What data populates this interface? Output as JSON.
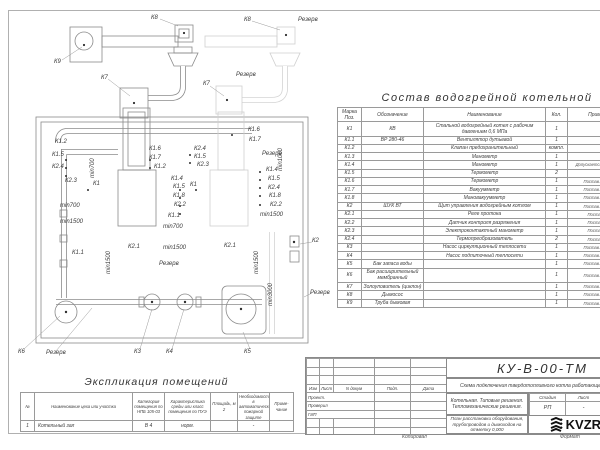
{
  "colors": {
    "line": "#8a8a8a",
    "light_line": "#cfcfcf",
    "text": "#3f3f3f",
    "logo_black": "#111111",
    "paper": "#ffffff"
  },
  "composition_table": {
    "title": "Состав водогрейной котельной",
    "headers": [
      "Марка Поз.",
      "Обозначение",
      "Наименование",
      "Кол.",
      "Примечание"
    ],
    "rows": [
      [
        "К1",
        "КВ",
        "Стальной водогрейный котел с рабочим давлением 0,6 МПа",
        "1",
        ""
      ],
      [
        "К1.1",
        "ВР 280-46",
        "Вентилятор дутьевой",
        "1",
        ""
      ],
      [
        "К1.2",
        "",
        "Клапан предохранительный",
        "компл.",
        ""
      ],
      [
        "К1.3",
        "",
        "Манометр",
        "1",
        ""
      ],
      [
        "К1.4",
        "",
        "Манометр",
        "1",
        "Допускается зам. поз. К2.3"
      ],
      [
        "К1.5",
        "",
        "Термометр",
        "2",
        ""
      ],
      [
        "К1.6",
        "",
        "Термометр",
        "1",
        "Постав. по соглас."
      ],
      [
        "К1.7",
        "",
        "Вакуумметр",
        "1",
        "Постав. по соглас."
      ],
      [
        "К1.8",
        "",
        "Мановакуумметр",
        "1",
        "Постав. по соглас."
      ],
      [
        "К2",
        "ШУК ВТ",
        "Щит управления водогрейным котлом",
        "1",
        "Постав. по соглас."
      ],
      [
        "К2.1",
        "",
        "Реле протока",
        "1",
        "Постав. с ШУК"
      ],
      [
        "К2.2",
        "",
        "Датчик контроля разряжения",
        "1",
        "Постав. с ШУК"
      ],
      [
        "К2.3",
        "",
        "Электроконтактный манометр",
        "1",
        "Постав. с ШУК"
      ],
      [
        "К2.4",
        "",
        "Термопреобразователь",
        "2",
        "Постав. с ШУК"
      ],
      [
        "К3",
        "",
        "Насос циркуляционный теплосети",
        "1",
        "Постав. по соглас."
      ],
      [
        "К4",
        "",
        "Насос подпиточный теплосети",
        "1",
        "Постав. по соглас."
      ],
      [
        "К5",
        "Бак запаса воды",
        "",
        "1",
        "Постав. по соглас."
      ],
      [
        "К6",
        "Бак расширительный мембранный",
        "",
        "1",
        "Постав. по соглас."
      ],
      [
        "К7",
        "Золоуловитель (циклон)",
        "",
        "1",
        "Постав. по соглас."
      ],
      [
        "К8",
        "Дымосос",
        "",
        "1",
        "Постав. по соглас."
      ],
      [
        "К9",
        "Труба дымовая",
        "",
        "1",
        "Постав. по соглас."
      ]
    ]
  },
  "explication_table": {
    "title": "Экспликация помещений",
    "headers": [
      "№",
      "Наименование цеха или участка",
      "Категория помещения по НПБ 105-03",
      "Характеристика среды или класс помещения по ПУЭ",
      "Площадь, м 2",
      "Необходимость в автоматической пожарной защите",
      "Приме- чание"
    ],
    "rows": [
      [
        "1",
        "Котельный зал",
        "В 4",
        "норм.",
        "",
        "-",
        ""
      ]
    ]
  },
  "title_block": {
    "doc_code": "КУ-В-00-ТМ",
    "doc_subtitle": "Схема подключения твердотопливного котла работающего на угле",
    "sign_headers": [
      "Изм",
      "Лист",
      "N докум",
      "Подп.",
      "Дата"
    ],
    "roles": [
      "Проект.",
      "Проверил",
      "ГИП"
    ],
    "object_name": "Котельная. Типовые решения. Тепломеханические решения.",
    "sheet_name": "План расстановки оборудования, трубопроводов и дымоходов на отметку 0,000",
    "stage_headers": [
      "Стадия",
      "Лист",
      "Листов"
    ],
    "stage_values": [
      "РП",
      "-",
      "-"
    ],
    "logo_text": "KVZR",
    "logo_caption_line1": "КОТЕЛЬН",
    "logo_caption_line2": "ЗАВОД Р",
    "copied_label": "Копировал",
    "format_label": "Формат"
  },
  "drawing_labels": [
    {
      "t": "К9",
      "x": 54,
      "y": 59
    },
    {
      "t": "К8",
      "x": 151,
      "y": 15
    },
    {
      "t": "К8",
      "x": 244,
      "y": 17
    },
    {
      "t": "Резерв",
      "x": 298,
      "y": 17
    },
    {
      "t": "К7",
      "x": 101,
      "y": 75
    },
    {
      "t": "К7",
      "x": 203,
      "y": 81
    },
    {
      "t": "Резерв",
      "x": 236,
      "y": 72
    },
    {
      "t": "К1.2",
      "x": 55,
      "y": 139
    },
    {
      "t": "К1.5",
      "x": 52,
      "y": 152
    },
    {
      "t": "К2.4",
      "x": 52,
      "y": 164
    },
    {
      "t": "К2.3",
      "x": 65,
      "y": 178
    },
    {
      "t": "К1",
      "x": 93,
      "y": 181
    },
    {
      "t": "min700",
      "x": 96,
      "y": 172,
      "r": 1
    },
    {
      "t": "К1.6",
      "x": 149,
      "y": 146
    },
    {
      "t": "К1.7",
      "x": 149,
      "y": 155
    },
    {
      "t": "К1.2",
      "x": 154,
      "y": 164
    },
    {
      "t": "К2.4",
      "x": 194,
      "y": 146
    },
    {
      "t": "К1.5",
      "x": 194,
      "y": 154
    },
    {
      "t": "К2.3",
      "x": 197,
      "y": 162
    },
    {
      "t": "К1.4",
      "x": 171,
      "y": 176
    },
    {
      "t": "К1.5",
      "x": 173,
      "y": 184
    },
    {
      "t": "К1.8",
      "x": 173,
      "y": 193
    },
    {
      "t": "К2.2",
      "x": 174,
      "y": 202
    },
    {
      "t": "К1.1",
      "x": 168,
      "y": 213
    },
    {
      "t": "min700",
      "x": 163,
      "y": 224
    },
    {
      "t": "К1",
      "x": 190,
      "y": 182
    },
    {
      "t": "min700",
      "x": 60,
      "y": 203
    },
    {
      "t": "min1500",
      "x": 60,
      "y": 219
    },
    {
      "t": "К1.6",
      "x": 248,
      "y": 127
    },
    {
      "t": "К1.7",
      "x": 249,
      "y": 137
    },
    {
      "t": "Резерв",
      "x": 262,
      "y": 151
    },
    {
      "t": "min1000",
      "x": 284,
      "y": 165,
      "r": 1
    },
    {
      "t": "К1.4",
      "x": 266,
      "y": 167
    },
    {
      "t": "К1.5",
      "x": 268,
      "y": 176
    },
    {
      "t": "К2.4",
      "x": 268,
      "y": 185
    },
    {
      "t": "К1.8",
      "x": 269,
      "y": 193
    },
    {
      "t": "К2.2",
      "x": 270,
      "y": 202
    },
    {
      "t": "min1500",
      "x": 260,
      "y": 212
    },
    {
      "t": "К1.1",
      "x": 72,
      "y": 250
    },
    {
      "t": "min1500",
      "x": 112,
      "y": 268,
      "r": 1
    },
    {
      "t": "К2.1",
      "x": 128,
      "y": 244
    },
    {
      "t": "min1500",
      "x": 163,
      "y": 245
    },
    {
      "t": "Резерв",
      "x": 159,
      "y": 261
    },
    {
      "t": "К2.1",
      "x": 224,
      "y": 243
    },
    {
      "t": "min1500",
      "x": 260,
      "y": 268,
      "r": 1
    },
    {
      "t": "min3000",
      "x": 274,
      "y": 300,
      "r": 1
    },
    {
      "t": "К2",
      "x": 312,
      "y": 238
    },
    {
      "t": "Резерв",
      "x": 310,
      "y": 290
    },
    {
      "t": "К6",
      "x": 18,
      "y": 349
    },
    {
      "t": "Резерв",
      "x": 46,
      "y": 350
    },
    {
      "t": "К3",
      "x": 134,
      "y": 349
    },
    {
      "t": "К4",
      "x": 166,
      "y": 349
    },
    {
      "t": "К5",
      "x": 244,
      "y": 349
    }
  ]
}
